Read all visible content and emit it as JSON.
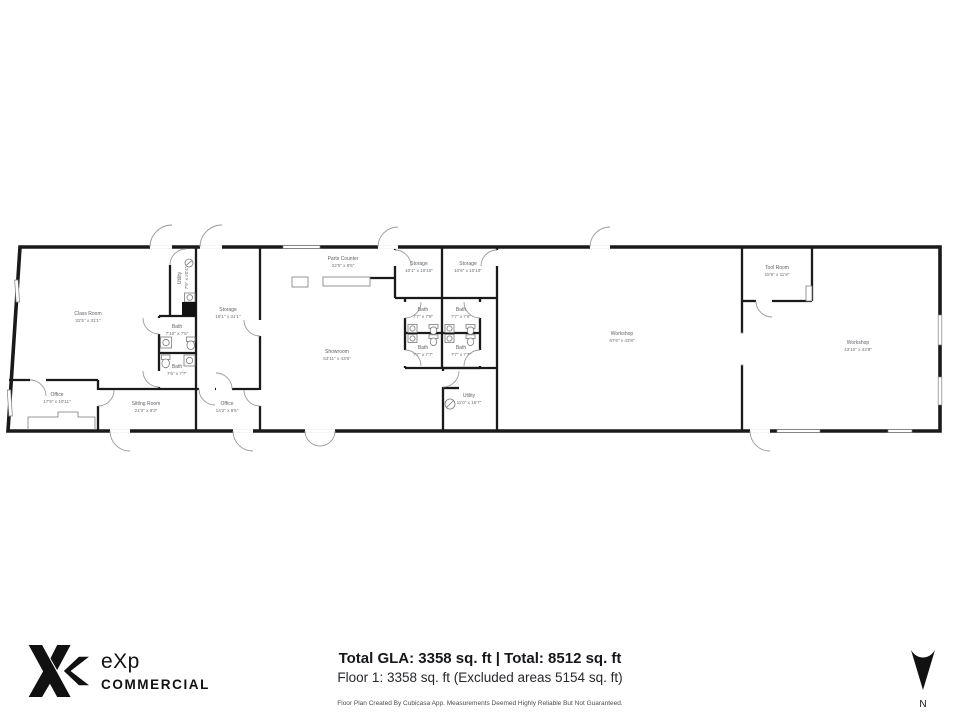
{
  "plan": {
    "type": "floor-plan",
    "floor": "Floor 1",
    "rooms": null
  },
  "rooms": [
    {
      "name": "Class Room",
      "dims": "32'5\" x 31'1\""
    },
    {
      "name": "Utility",
      "dims": "7'9\" x 20'4\""
    },
    {
      "name": "Bath",
      "dims": "7'10\" x 7'6\""
    },
    {
      "name": "Bath",
      "dims": "7'6\" x 7'7\""
    },
    {
      "name": "Storage",
      "dims": "16'1\" x 31'1\""
    },
    {
      "name": "Office",
      "dims": "17'9\" x 10'11\""
    },
    {
      "name": "Sitting Room",
      "dims": "21'3\" x 9'3\""
    },
    {
      "name": "Office",
      "dims": "14'2\" x 9'5\""
    },
    {
      "name": "Parts Counter",
      "dims": "22'5\" x 8'6\""
    },
    {
      "name": "Showroom",
      "dims": "53'11\" x 43'8\""
    },
    {
      "name": "Storage",
      "dims": "10'1\" x 10'10\""
    },
    {
      "name": "Storage",
      "dims": "10'6\" x 10'10\""
    },
    {
      "name": "Bath",
      "dims": "7'7\" x 7'9\""
    },
    {
      "name": "Bath",
      "dims": "7'7\" x 7'9\""
    },
    {
      "name": "Bath",
      "dims": "7'7\" x 7'7\""
    },
    {
      "name": "Bath",
      "dims": "7'7\" x 7'7\""
    },
    {
      "name": "Utility",
      "dims": "11'0\" x 15'7\""
    },
    {
      "name": "Workshop",
      "dims": "67'6\" x 43'8\""
    },
    {
      "name": "Tool Room",
      "dims": "15'9\" x 11'8\""
    },
    {
      "name": "Workshop",
      "dims": "43'10\" x 43'8\""
    }
  ],
  "footer": {
    "totals_main": "Total GLA: 3358 sq. ft | Total: 8512 sq. ft",
    "totals_floor": "Floor 1: 3358 sq. ft (Excluded areas 5154 sq. ft)",
    "disclaimer": "Floor Plan Created By Cubicasa App. Measurements Deemed Highly Reliable But Not Guaranteed."
  },
  "logo": {
    "brand": "eXp",
    "division": "COMMERCIAL"
  },
  "compass": {
    "label": "N",
    "direction": "down"
  },
  "colors": {
    "wall": "#1a1a1a",
    "door": "#8a8a8a",
    "label": "#5f6368",
    "brand": "#111111"
  }
}
